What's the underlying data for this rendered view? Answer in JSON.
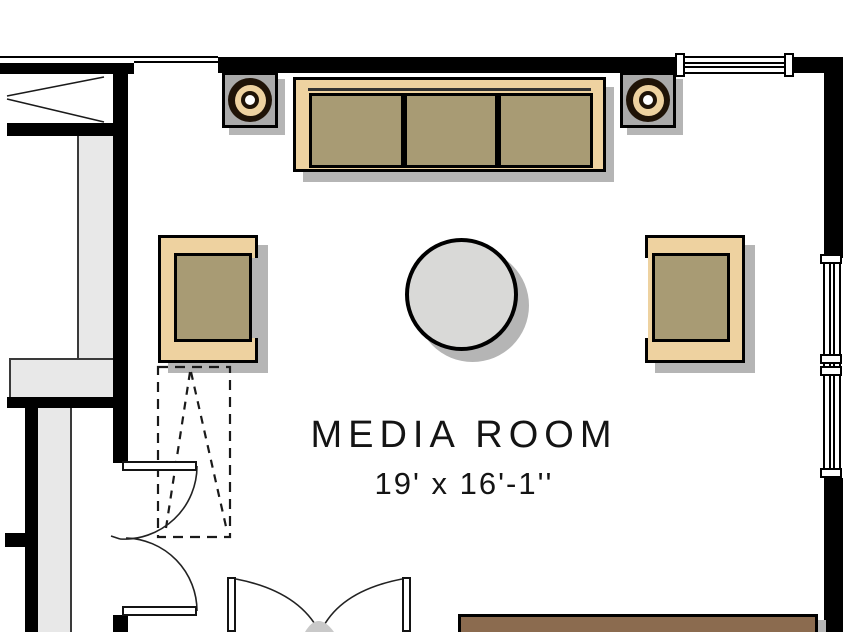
{
  "room": {
    "name": "MEDIA ROOM",
    "dimensions": "19' x 16'-1''"
  },
  "palette": {
    "paper": "#ffffff",
    "wall": "#000000",
    "structure_gray": "#e8e8e8",
    "structure_line": "#3a3a3a",
    "shadow": "#b5b5b5",
    "tan": "#eed2a0",
    "cushion": "#a89b74",
    "speaker_gray": "#aaaaaa",
    "ring_dark": "#1f1307",
    "table_gray": "#d9d9d7",
    "console_brown": "#8b6b4f",
    "door_line": "#141414",
    "text": "#141414"
  },
  "elements": {
    "furniture": [
      "sofa",
      "left speaker",
      "right speaker",
      "left armchair",
      "right armchair",
      "round table",
      "console table"
    ],
    "architecture": [
      "top wall with window",
      "right wall with window",
      "interior left wall",
      "upper swing door",
      "lower swing door",
      "french double doors",
      "dashed overhead outline",
      "cased opening marker"
    ]
  }
}
